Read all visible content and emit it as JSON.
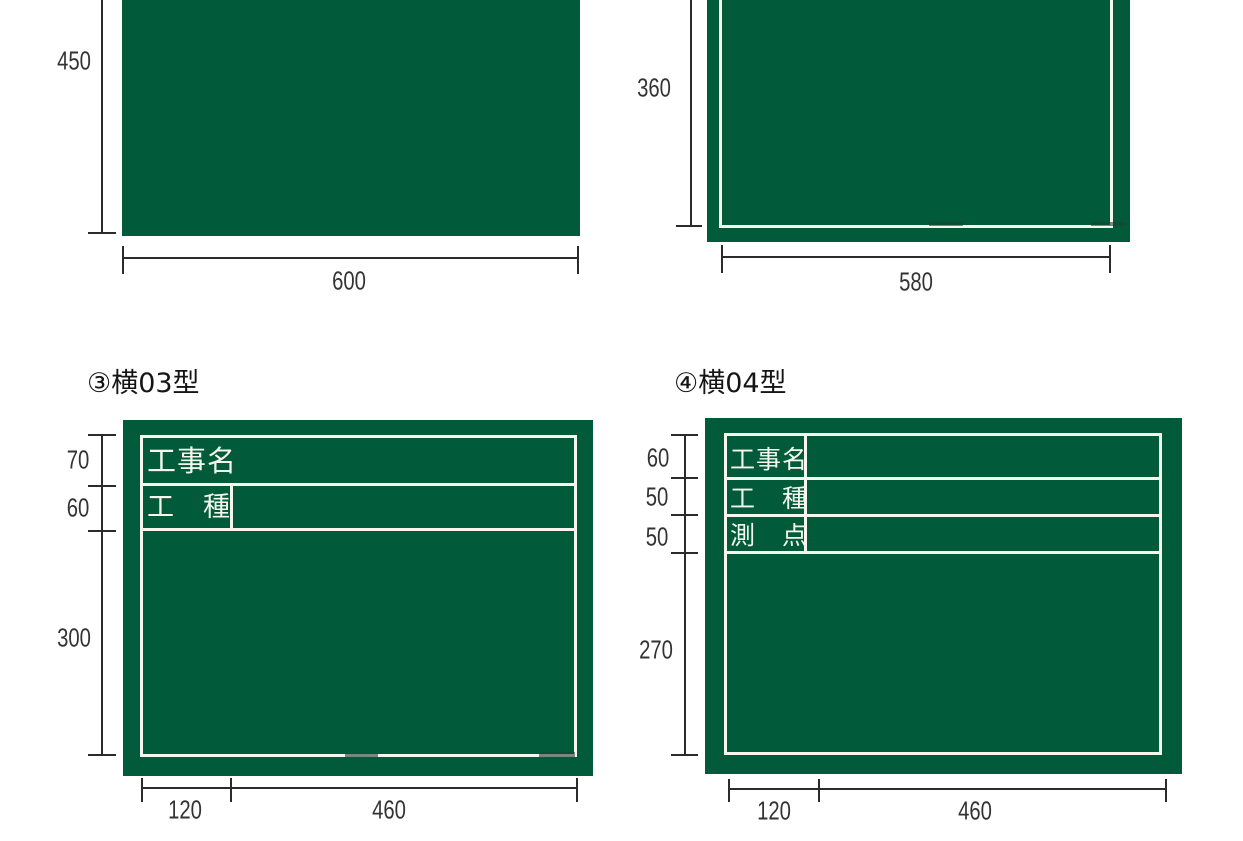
{
  "colors": {
    "board_green": "#015B3A",
    "board_line_white": "#F6F6EF",
    "dimension_line": "#2B2B2B",
    "dimension_text": "#333333",
    "title_text": "#151515",
    "background": "#FFFFFF"
  },
  "panels": [
    {
      "name": "blank-board-600x450",
      "board": {
        "style": "plain-green"
      },
      "height_dims": [
        {
          "text": "450"
        }
      ],
      "width_dims": [
        {
          "text": "600"
        }
      ]
    },
    {
      "name": "bordered-board-580x360",
      "board": {
        "style": "white-inner-border"
      },
      "height_dims": [
        {
          "text": "360"
        }
      ],
      "width_dims": [
        {
          "text": "580"
        }
      ]
    },
    {
      "name": "yoko-03",
      "title": "③横03型",
      "board": {
        "style": "white-inner-border",
        "fields": [
          {
            "label": "工事名"
          },
          {
            "label": "工　種"
          }
        ]
      },
      "height_dims": [
        {
          "text": "70"
        },
        {
          "text": "60"
        },
        {
          "text": "300"
        }
      ],
      "width_dims": [
        {
          "text": "120"
        },
        {
          "text": "460"
        }
      ]
    },
    {
      "name": "yoko-04",
      "title": "④横04型",
      "board": {
        "style": "white-inner-border",
        "fields": [
          {
            "label": "工事名"
          },
          {
            "label": "工　種"
          },
          {
            "label": "測　点"
          }
        ]
      },
      "height_dims": [
        {
          "text": "60"
        },
        {
          "text": "50"
        },
        {
          "text": "50"
        },
        {
          "text": "270"
        }
      ],
      "width_dims": [
        {
          "text": "120"
        },
        {
          "text": "460"
        }
      ]
    }
  ]
}
